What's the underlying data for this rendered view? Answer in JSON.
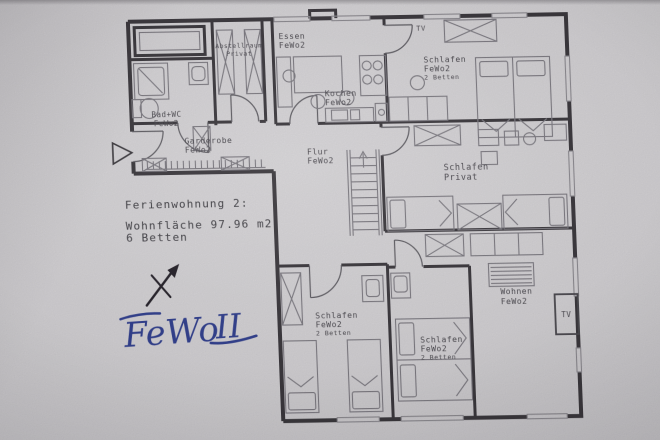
{
  "info": {
    "l1": "Ferienwohnung 2:",
    "l2": "Wohnfläche 97.96 m2",
    "l3": "6 Betten"
  },
  "rooms": {
    "bad": {
      "l1": "Bad+WC",
      "l2": "FeWo2"
    },
    "abstell": {
      "l1": "Abstellraum",
      "l2": "Privat"
    },
    "garderobe": {
      "l1": "Garderobe",
      "l2": "FeWo2"
    },
    "essen": {
      "l1": "Essen",
      "l2": "FeWo2"
    },
    "kochen": {
      "l1": "Kochen",
      "l2": "FeWo2"
    },
    "schlafen_top": {
      "l1": "Schlafen",
      "l2": "FeWo2",
      "l3": "2 Betten"
    },
    "flur": {
      "l1": "Flur",
      "l2": "FeWo2"
    },
    "schlafen_privat": {
      "l1": "Schlafen",
      "l2": "Privat"
    },
    "schlafen_left": {
      "l1": "Schlafen",
      "l2": "FeWo2",
      "l3": "2 Betten"
    },
    "schlafen_mid": {
      "l1": "Schlafen",
      "l2": "FeWo2",
      "l3": "2 Betten"
    },
    "wohnen": {
      "l1": "Wohnen",
      "l2": "FeWo2"
    }
  },
  "labels": {
    "tv_top": "TV",
    "tv_living": "TV"
  },
  "handwriting": {
    "word": "FeWo",
    "numeral": "II"
  },
  "colors": {
    "paper": "#cfcdd0",
    "ink": "#3a383d",
    "furniture": "#7b7980",
    "text": "#4c4a50",
    "pen": "#32408d"
  }
}
